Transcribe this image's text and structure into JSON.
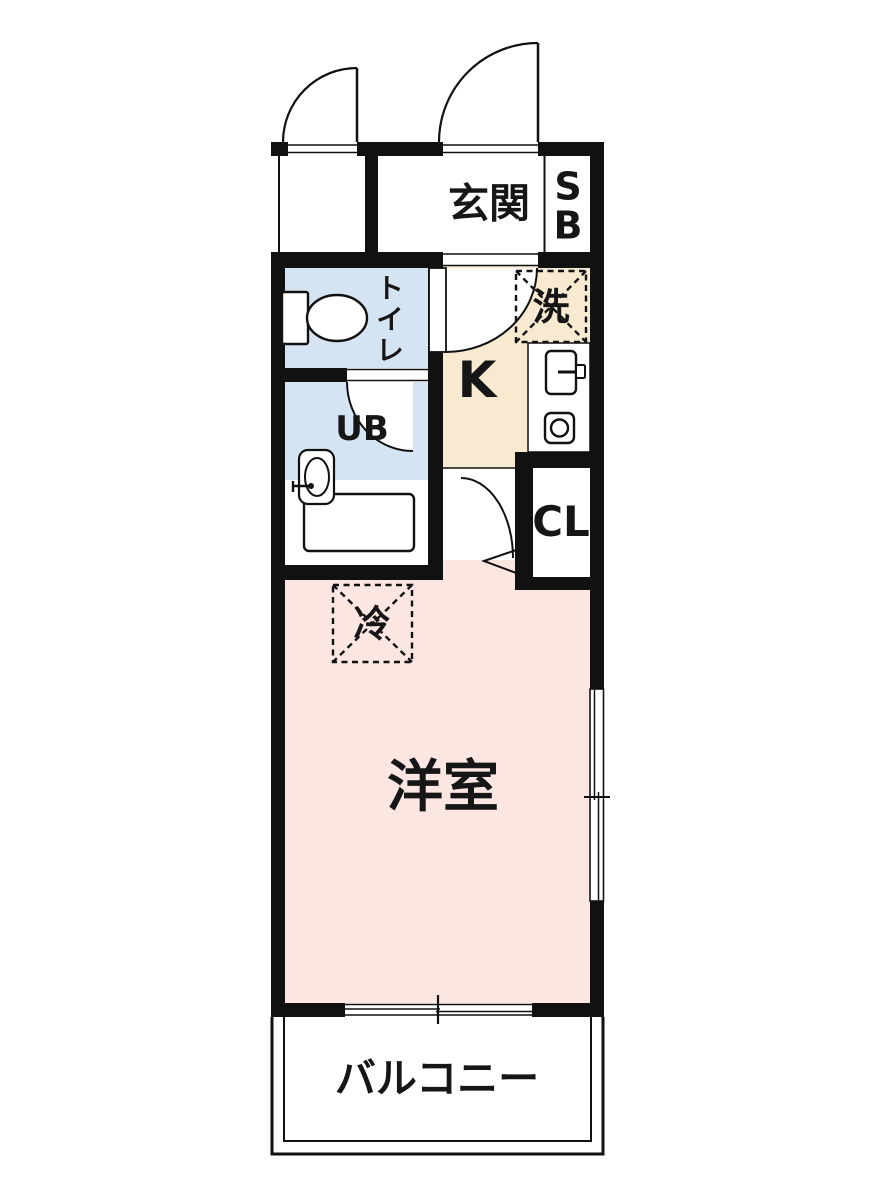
{
  "document": {
    "kind": "apartment-floor-plan"
  },
  "colors": {
    "wall": "#111111",
    "room_pink": "#fce6e1",
    "water_blue": "#d5e4f3",
    "kitchen_cream": "#f8ead1",
    "label": "#161616",
    "bg": "#ffffff"
  },
  "rooms": {
    "entrance": {
      "label": "玄関"
    },
    "shoe_box": {
      "label": "SB"
    },
    "toilet": {
      "label": "トイレ"
    },
    "washer_space": {
      "label": "洗"
    },
    "kitchen": {
      "label": "K"
    },
    "unit_bath": {
      "label": "UB"
    },
    "closet": {
      "label": "CL"
    },
    "refrigerator": {
      "label": "冷"
    },
    "western_room": {
      "label": "洋室"
    },
    "balcony": {
      "label": "バルコニー"
    }
  }
}
